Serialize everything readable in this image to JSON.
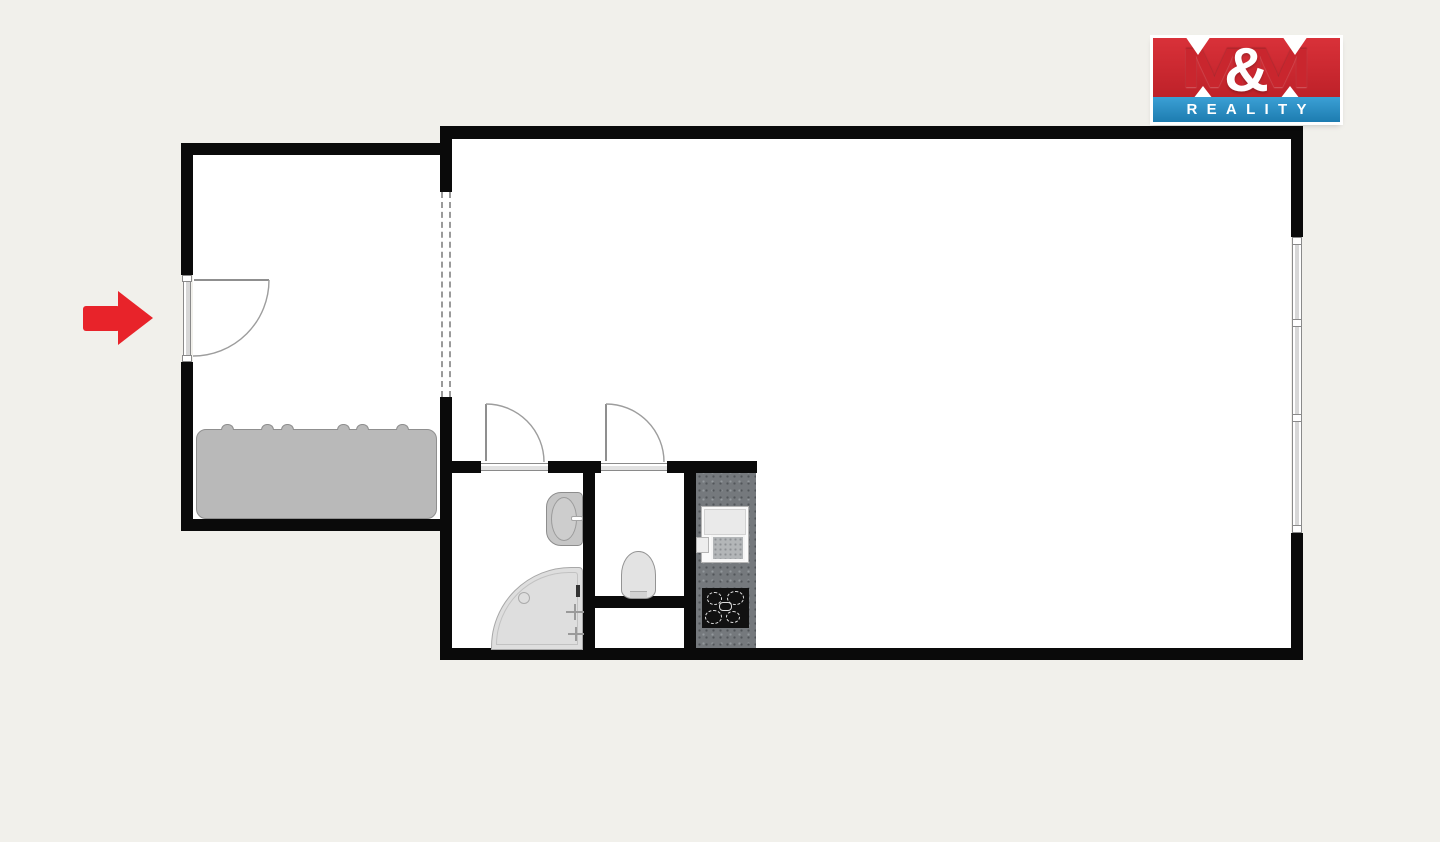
{
  "brand": {
    "name": "M&M REALITY",
    "m_left": "M",
    "amp": "&",
    "m_right": "M",
    "reality": "REALITY",
    "red": "#d2262e",
    "blue": "#2e93c9"
  },
  "colors": {
    "page_background": "#f1f0eb",
    "wall": "#0a0a0a",
    "room_floor": "#ffffff",
    "entrance_arrow": "#e8232a",
    "wardrobe_gray": "#b9b9b9",
    "fixture_gray": "#dedede",
    "counter_gray": "#75797d",
    "cooktop_black": "#111111"
  },
  "floorplan": {
    "rooms": [
      "entrance-hall",
      "main-room",
      "bathroom",
      "wc",
      "kitchen-strip",
      "shaft-niche"
    ],
    "fixtures": [
      "entrance-door",
      "wardrobe",
      "open-passage-dashed",
      "bathroom-door",
      "wc-door",
      "wash-basin",
      "corner-bath",
      "shower-fittings",
      "toilet",
      "kitchen-counter",
      "kitchen-sink",
      "cooktop",
      "window-wall"
    ]
  }
}
